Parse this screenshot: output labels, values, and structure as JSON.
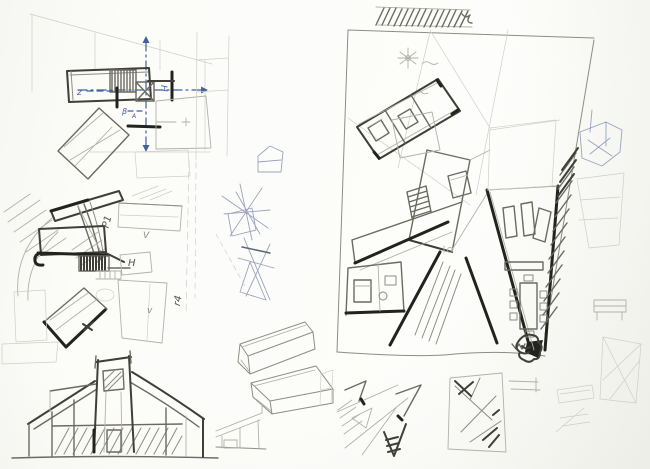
{
  "page": {
    "label": "scanned architectural sketch sheet",
    "width": 650,
    "height": 469,
    "paper_color": "#fcfcf9"
  },
  "palette": {
    "pencil_faint": "#cfcfc8",
    "pencil_light": "#b2b2aa",
    "pencil_mid": "#8d8d84",
    "pencil_dark": "#55554d",
    "ink_black": "#22221e",
    "ink_blue": "#41619f",
    "blue_faint": "#9aa3bd"
  },
  "sketches": [
    {
      "id": "plan-study-top-left",
      "label": "small floor plan study with blue axis arrows"
    },
    {
      "id": "plan-study-mid-left",
      "label": "floor plan study with stair hatch and rotated volume"
    },
    {
      "id": "elevation-bottom-left",
      "label": "building elevation sketch with hatched base"
    },
    {
      "id": "concept-lines-center",
      "label": "faint radiating concept line studies"
    },
    {
      "id": "main-floor-plan",
      "label": "large fragmented floor plan with furniture and hatched edge"
    },
    {
      "id": "axonometric-boxes",
      "label": "axonometric volume studies"
    },
    {
      "id": "right-margin-studies",
      "label": "faint margin studies and framed diagonals"
    },
    {
      "id": "thumbnail-plans-bottom",
      "label": "thumbnail plan diagrams"
    }
  ],
  "annotations": {
    "plan1_z": "z",
    "plan1_h": "H",
    "plan1_beta": "β",
    "plan1_a": "A",
    "plan2_p1": "P1",
    "plan2_v_upper": "V",
    "plan2_h": "H",
    "plan2_v_lower": "v",
    "plan2_r4": "r4"
  }
}
